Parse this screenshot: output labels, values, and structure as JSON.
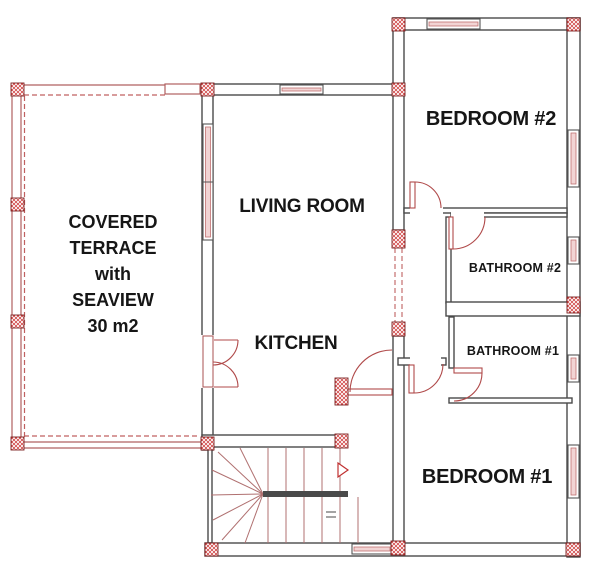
{
  "plan": {
    "title": "floor-plan",
    "rooms": {
      "terrace": {
        "lines": [
          "COVERED",
          "TERRACE",
          "with",
          "SEAVIEW",
          "30 m2"
        ]
      },
      "living_room": {
        "label": "LIVING ROOM"
      },
      "kitchen": {
        "label": "KITCHEN"
      },
      "bedroom2": {
        "label": "BEDROOM #2"
      },
      "bathroom2": {
        "label": "BATHROOM #2"
      },
      "bathroom1": {
        "label": "BATHROOM #1"
      },
      "bedroom1": {
        "label": "BEDROOM #1"
      }
    },
    "colors": {
      "wall": "#4a4a4a",
      "column_red": "#c03030",
      "terrace_line_red": "#b06060",
      "door_arc_red": "#b04a4a",
      "window_pink": "#f2d4d4",
      "background": "#ffffff",
      "text": "#161616"
    }
  }
}
